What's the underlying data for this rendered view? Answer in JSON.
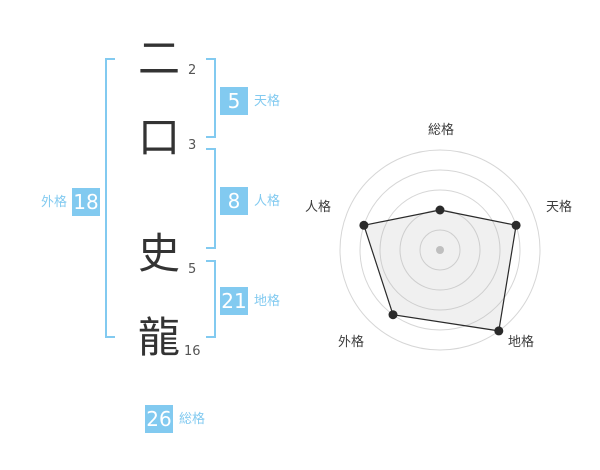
{
  "name_panel": {
    "characters": [
      {
        "glyph": "二",
        "strokes": "2"
      },
      {
        "glyph": "口",
        "strokes": "3"
      },
      {
        "glyph": "史",
        "strokes": "5"
      },
      {
        "glyph": "龍",
        "strokes": "16"
      }
    ],
    "kaku": {
      "tenkaku": {
        "label": "天格",
        "value": "5"
      },
      "jinkaku": {
        "label": "人格",
        "value": "8"
      },
      "chikaku": {
        "label": "地格",
        "value": "21"
      },
      "gaikaku": {
        "label": "外格",
        "value": "18"
      },
      "soukaku": {
        "label": "総格",
        "value": "26"
      }
    }
  },
  "chart_data": {
    "type": "radar",
    "categories": [
      "総格",
      "天格",
      "地格",
      "外格",
      "人格"
    ],
    "values": [
      40,
      80,
      100,
      80,
      80
    ],
    "max": 100,
    "gridlines": [
      20,
      40,
      60,
      80,
      100
    ],
    "grid": true,
    "legend": false,
    "title": ""
  },
  "colors": {
    "accent_blue": "#82CAF0",
    "box_value_text": "#ffffff",
    "name_text": "#333333",
    "stroke_count_text": "#555555",
    "chart_label": "#3d3d3d",
    "chart_grid": "#d6d6d6",
    "polygon_stroke": "#2a2a2a",
    "polygon_fill": "rgba(170,170,170,0.18)",
    "center_dot": "#bfbfbf"
  }
}
